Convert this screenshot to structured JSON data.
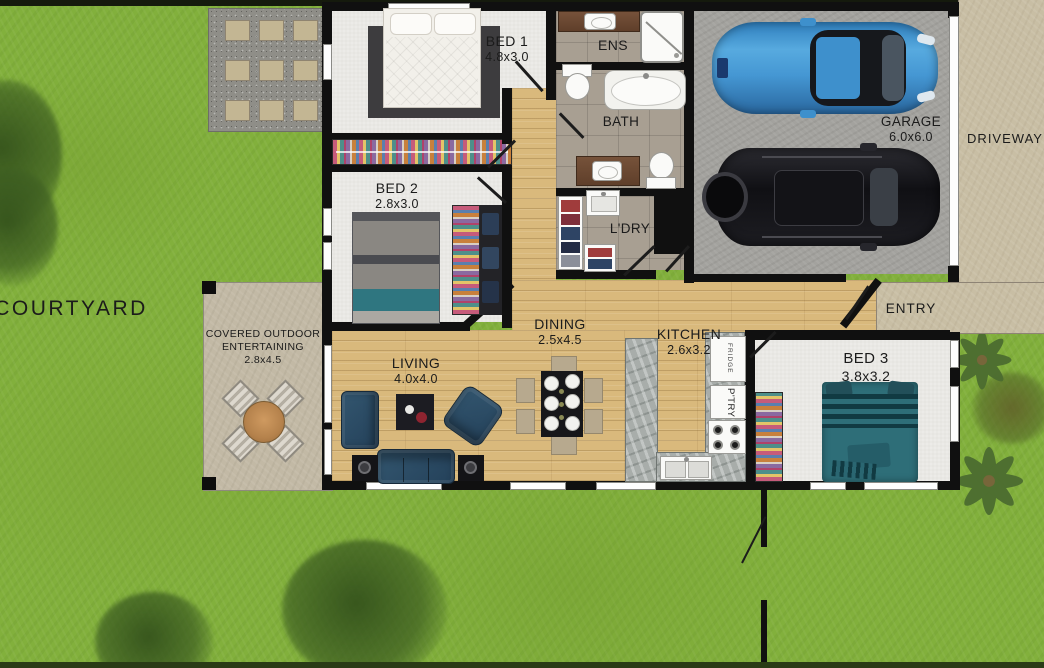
{
  "labels": {
    "courtyard": "COURTYARD",
    "driveway": "DRIVEWAY",
    "entry": "ENTRY",
    "garage": {
      "name": "GARAGE",
      "dims": "6.0x6.0"
    },
    "bed1": {
      "name": "BED 1",
      "dims": "4.8x3.0"
    },
    "bed2": {
      "name": "BED 2",
      "dims": "2.8x3.0"
    },
    "bed3": {
      "name": "BED 3",
      "dims": "3.8x3.2"
    },
    "ens": {
      "name": "ENS"
    },
    "bath": {
      "name": "BATH"
    },
    "ldry": {
      "name": "L'DRY"
    },
    "living": {
      "name": "LIVING",
      "dims": "4.0x4.0"
    },
    "dining": {
      "name": "DINING",
      "dims": "2.5x4.5"
    },
    "kitchen": {
      "name": "KITCHEN",
      "dims": "2.6x3.2"
    },
    "outdoor": {
      "line1": "COVERED OUTDOOR",
      "line2": "ENTERTAINING",
      "dims": "2.8x4.5"
    },
    "fridge": "FRIDGE",
    "pantry": "P'TRY"
  },
  "colors": {
    "grass": "#82b03c",
    "wall": "#101010",
    "timber_floor": "#d9b97c",
    "carpet": "#e9e8e4",
    "tile": "#a89f92",
    "garage_concrete": "#a3a29e",
    "paving_concrete": "#c8bea4",
    "gravel": "#8f8e88",
    "stone_bench": "#a8adaa",
    "sofa_navy": "#2d4d66",
    "bed_teal": "#2e6e78",
    "car_blue": "#3f93d2",
    "car_black": "#1d1d22",
    "outdoor_table_wood": "#c08b4f"
  }
}
